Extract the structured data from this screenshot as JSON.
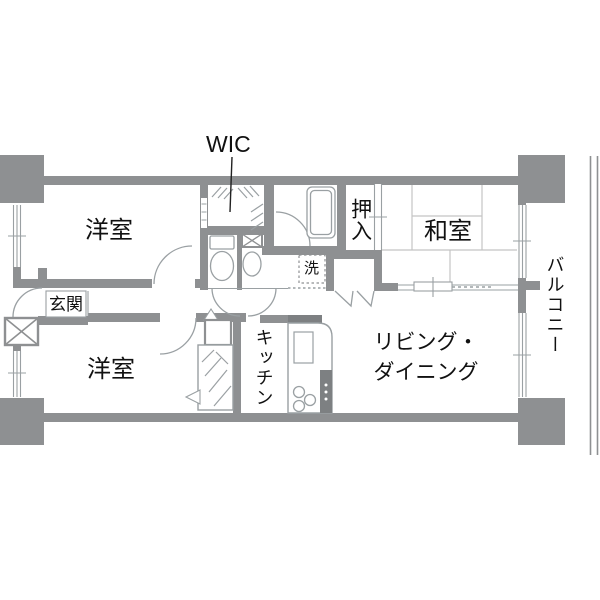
{
  "floorplan": {
    "labels": {
      "wic": "WIC",
      "bedroom_top": "洋室",
      "bedroom_bottom": "洋室",
      "japanese_room": "和室",
      "oshiire": "押入",
      "laundry": "洗",
      "entrance": "玄関",
      "kitchen": "キッチン",
      "living_dining_line1": "リビング・",
      "living_dining_line2": "ダイニング",
      "balcony": "バルコニー"
    },
    "colors": {
      "wall": "#8e9092",
      "wall_dark": "#7d8082",
      "fixture_line": "#9aa0a3",
      "tatami_line": "#c4c4c4",
      "text": "#111111",
      "background": "#ffffff"
    }
  }
}
